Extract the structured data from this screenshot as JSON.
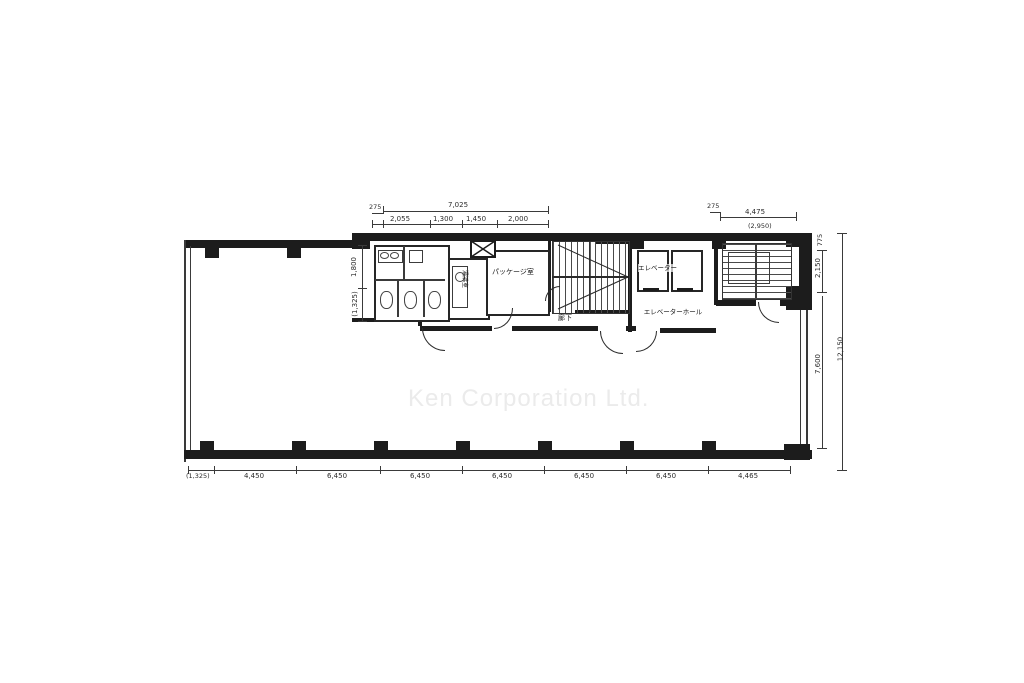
{
  "watermark": {
    "text": "Ken Corporation Ltd.",
    "color": "#ebebeb"
  },
  "rooms": {
    "package_room": "パッケージ室",
    "kitchenette": "湯沸室",
    "elevator": "エレベーター",
    "elevator_hall": "エレベーターホール",
    "corridor": "廊下"
  },
  "dimensions": {
    "top_left": {
      "offset": "275",
      "overall": "7,025",
      "segments": [
        "2,055",
        "1,300",
        "1,450",
        "2,000"
      ]
    },
    "top_right": {
      "offset": "275",
      "width": "4,475",
      "note": "(2,950)"
    },
    "left_side": {
      "upper": "1,800",
      "lower": "(1,325)"
    },
    "right_side": {
      "top": "775",
      "upper": "2,150",
      "lower": "7,600",
      "total": "12,150"
    },
    "bottom": {
      "segments": [
        "(1,325)",
        "4,450",
        "6,450",
        "6,450",
        "6,450",
        "6,450",
        "6,450",
        "4,465"
      ]
    }
  },
  "colors": {
    "wall": "#1c1c1c",
    "dim_text": "#2b2b2b"
  }
}
